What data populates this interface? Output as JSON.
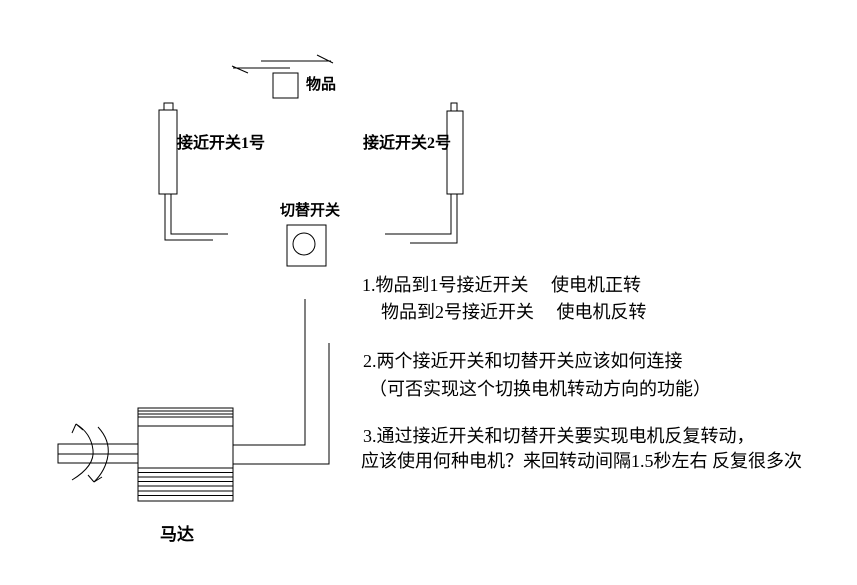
{
  "page": {
    "background_color": "#ffffff",
    "line_color": "#000000",
    "text_color": "#000000"
  },
  "diagram": {
    "object_label": "物品",
    "switch1_label": "接近开关1号",
    "switch2_label": "接近开关2号",
    "toggle_label": "切替开关",
    "motor_label": "马达"
  },
  "notes": {
    "item1_line1": "1.物品到1号接近开关　 使电机正转",
    "item1_line2": "物品到2号接近开关　 使电机反转",
    "item2_line1": "2.两个接近开关和切替开关应该如何连接",
    "item2_line2": "（可否实现这个切换电机转动方向的功能）",
    "item3_line1": "3.通过接近开关和切替开关要实现电机反复转动，",
    "item3_line2": "应该使用何种电机？来回转动间隔1.5秒左右 反复很多次"
  }
}
